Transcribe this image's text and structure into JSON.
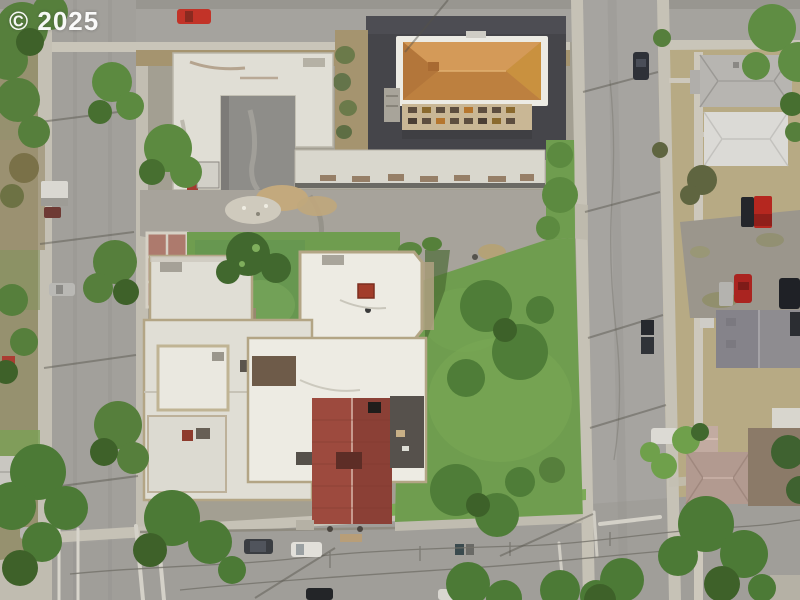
{
  "image": {
    "kind": "aerial drone photograph, top-down nadir view of a city block",
    "width": 800,
    "height": 600
  },
  "watermark": {
    "text": "© 2025",
    "color": "#ffffff"
  },
  "palette": {
    "ground_base": "#9a9786",
    "street": "#a5a39e",
    "street_side": "#a2a09b",
    "street_right": "#a6a4a0",
    "street_bottom": "#a09e99",
    "sidewalk": "#c9c5b9",
    "sidewalk_dim": "#c2beb2",
    "asphalt_lot": "#45454a",
    "dirt": "#a5946f",
    "plaza": "#a7a39b",
    "grass": "#6f9d4f",
    "grass_bright": "#7cab57",
    "grass_dark": "#679750",
    "grass_dry": "#b7aa84",
    "lawn_shadow": "#46672f",
    "tree": "#567f3c",
    "tree_dark": "#3e6129",
    "tree_light": "#6f9d4a",
    "tree_olive": "#6d7244",
    "roof_white": "#e0ded5",
    "roof_white_bright": "#edebe3",
    "roof_strip": "#d9d7cd",
    "parapet": "#b3a585",
    "courtyard_concrete": "#8e8d89",
    "roof_orange": "#c88c4c",
    "roof_orange_light": "#d49a58",
    "roof_orange_dark": "#bd803f",
    "facade_tan": "#c9b795",
    "roof_red_west": "#9d4a3e",
    "roof_red_east": "#8b4036",
    "brick_court": "#ad7a6d",
    "brick_facade": "#98886e",
    "chimney_red": "#a23d2b",
    "roof_house_gray": "#b7b5b1",
    "roof_house_white": "#dbdad6",
    "roof_house_dark": "#8e8c90",
    "roof_mauve": "#b29a90",
    "roof_brown": "#8b7a68",
    "gravel": "#9b968c",
    "marking_white": "#d8d5cc"
  },
  "vehicles": [
    {
      "name": "red-car-top-street",
      "color": "#c23328"
    },
    {
      "name": "black-car-top-left",
      "color": "#33353a"
    },
    {
      "name": "white-rv-left-street",
      "color": "#dad8d2"
    },
    {
      "name": "dark-red-car-left-street",
      "color": "#6e3a34"
    },
    {
      "name": "silver-car-left-street",
      "color": "#b9b8b4"
    },
    {
      "name": "silver-car-bottom-left",
      "color": "#b5b4b0"
    },
    {
      "name": "dark-van-bottom-street",
      "color": "#3a3d42"
    },
    {
      "name": "white-van-bottom-street",
      "color": "#e2e0da"
    },
    {
      "name": "black-car-bottom-edge",
      "color": "#232528"
    },
    {
      "name": "white-car-bottom-edge",
      "color": "#d8d6d0"
    },
    {
      "name": "dark-car-right-street",
      "color": "#2e3138"
    },
    {
      "name": "black-pickup-right-a",
      "color": "#27292e"
    },
    {
      "name": "black-pickup-right-b",
      "color": "#303338"
    },
    {
      "name": "red-truck-gravel-lot",
      "color": "#b5271f"
    },
    {
      "name": "black-truck-gravel-lot",
      "color": "#24262b"
    },
    {
      "name": "red-car-gravel-lot",
      "color": "#aa2420"
    },
    {
      "name": "silver-car-gravel-lot",
      "color": "#b4b3af"
    },
    {
      "name": "black-suv-gravel-lot",
      "color": "#1f2126"
    },
    {
      "name": "dark-car-gravel-lot",
      "color": "#2b2d32"
    },
    {
      "name": "white-car-right-street",
      "color": "#dcdad4"
    }
  ]
}
